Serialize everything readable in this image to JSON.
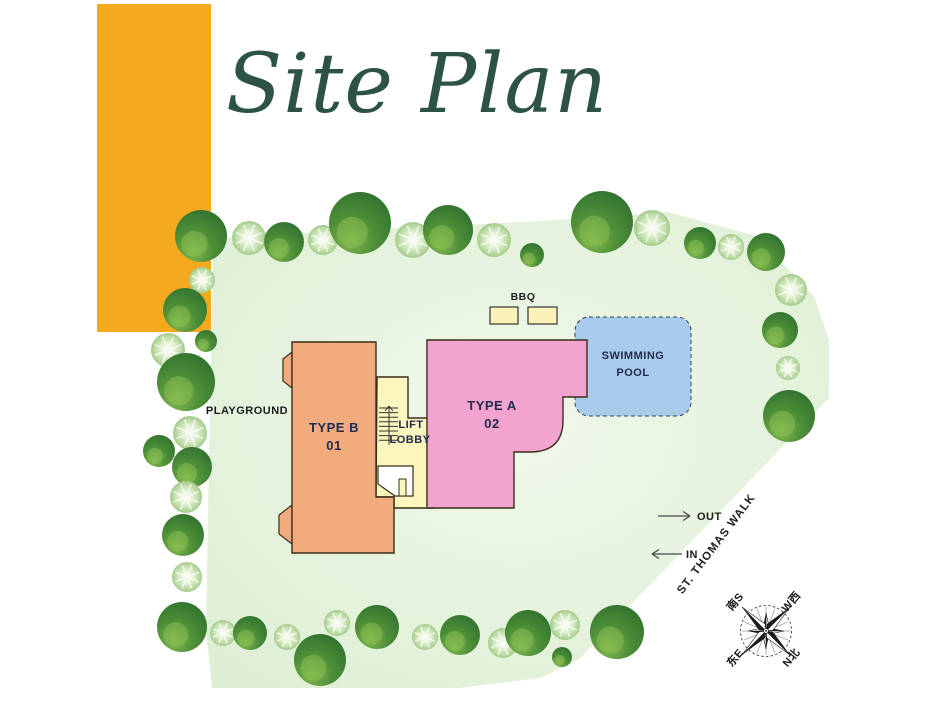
{
  "header": {
    "title": "Site Plan",
    "title_color": "#2d5246",
    "accent_bar_color": "#F5A91F"
  },
  "plan": {
    "site": {
      "polygon": "213,238 540,221 668,212 756,236 814,296 829,340 829,398 578,660 540,678 460,688 212,688 206,630",
      "fill_center": "#f0f8ea",
      "fill_edge": "#ddeed3"
    },
    "tree_colors": {
      "dark_outer": "#2a6c2d",
      "dark_mid": "#4e8f38",
      "dark_light": "#86bb50",
      "light_core": "#ffffff",
      "light_mid": "#dceecb",
      "light_edge": "#8fbf72"
    },
    "trees": [
      [
        "d",
        201,
        236,
        26
      ],
      [
        "l",
        249,
        238,
        17
      ],
      [
        "d",
        284,
        242,
        20
      ],
      [
        "l",
        323,
        240,
        15
      ],
      [
        "d",
        360,
        223,
        31
      ],
      [
        "l",
        413,
        240,
        18
      ],
      [
        "d",
        448,
        230,
        25
      ],
      [
        "l",
        494,
        240,
        17
      ],
      [
        "d",
        532,
        255,
        12
      ],
      [
        "d",
        602,
        222,
        31
      ],
      [
        "l",
        652,
        228,
        18
      ],
      [
        "d",
        700,
        243,
        16
      ],
      [
        "l",
        731,
        247,
        13
      ],
      [
        "d",
        766,
        252,
        19
      ],
      [
        "l",
        791,
        290,
        16
      ],
      [
        "d",
        780,
        330,
        18
      ],
      [
        "l",
        788,
        368,
        12
      ],
      [
        "d",
        789,
        416,
        26
      ],
      [
        "l",
        202,
        280,
        13
      ],
      [
        "d",
        185,
        310,
        22
      ],
      [
        "d",
        206,
        341,
        11
      ],
      [
        "l",
        168,
        350,
        17
      ],
      [
        "d",
        186,
        382,
        29
      ],
      [
        "l",
        190,
        433,
        17
      ],
      [
        "d",
        159,
        451,
        16
      ],
      [
        "d",
        192,
        467,
        20
      ],
      [
        "l",
        186,
        497,
        16
      ],
      [
        "d",
        183,
        535,
        21
      ],
      [
        "l",
        187,
        577,
        15
      ],
      [
        "d",
        182,
        627,
        25
      ],
      [
        "l",
        223,
        633,
        13
      ],
      [
        "d",
        250,
        633,
        17
      ],
      [
        "l",
        287,
        637,
        13
      ],
      [
        "d",
        320,
        660,
        26
      ],
      [
        "l",
        337,
        623,
        13
      ],
      [
        "d",
        377,
        627,
        22
      ],
      [
        "l",
        425,
        637,
        13
      ],
      [
        "d",
        460,
        635,
        20
      ],
      [
        "l",
        503,
        643,
        15
      ],
      [
        "d",
        528,
        633,
        23
      ],
      [
        "l",
        565,
        625,
        15
      ],
      [
        "d",
        562,
        657,
        10
      ],
      [
        "d",
        617,
        632,
        27
      ]
    ],
    "outline_color": "#3a2d1a",
    "label_color": "#232a52",
    "buildings": {
      "type_b": {
        "line1": "TYPE B",
        "line2": "01",
        "fill": "#f1ab7d",
        "path": "M292,342 L376,342 L376,497 L394,497 L394,553 L292,553 Z",
        "tabs": [
          "292,352 283,359 283,381 292,388",
          "292,505 279,515 279,534 292,544"
        ],
        "label_x": 334,
        "label_y1": 432,
        "label_y2": 450
      },
      "type_a": {
        "line1": "TYPE A",
        "line2": "02",
        "fill": "#f2a3ce",
        "path": "M433,340 L587,340 L587,397 L563,397 L563,420 Q563,452 530,452 L514,452 L514,508 L427,508 L427,340 Z",
        "label_x": 492,
        "label_y1": 410,
        "label_y2": 428
      },
      "lobby": {
        "line1": "LIFT",
        "line2": "LOBBY",
        "fill": "#fbf5be",
        "path": "M377,377 L408,377 L408,418 L433,418 L433,508 L394,508 L394,497 L376,497 Z",
        "notch": "378,466 413,466 413,496 395,496 378,484",
        "notch_tab": {
          "x": 399,
          "y": 479,
          "w": 7,
          "h": 17
        },
        "stairs": {
          "x1": 379,
          "x2": 398,
          "y_top": 408,
          "rungs": 8,
          "step": 4.6,
          "arrow_x": 389
        },
        "label_x1": 411,
        "label_y1": 428,
        "label_x2": 410,
        "label_y2": 443
      },
      "pool": {
        "line1": "SWIMMING",
        "line2": "POOL",
        "fill": "#a9cbec",
        "x": 575,
        "y": 317,
        "w": 116,
        "h": 99,
        "rx": 14,
        "label_x": 633,
        "label_y1": 359,
        "label_y2": 376
      }
    },
    "bbq": {
      "label": "BBQ",
      "label_x": 523,
      "label_y": 300,
      "fill": "#faf2b8",
      "pits": [
        {
          "x": 490,
          "y": 307,
          "w": 28,
          "h": 17
        },
        {
          "x": 528,
          "y": 307,
          "w": 29,
          "h": 17
        }
      ]
    },
    "playground": {
      "label": "PLAYGROUND",
      "x": 247,
      "y": 414
    },
    "arrows": {
      "out": {
        "label": "OUT",
        "x1": 658,
        "x2": 690,
        "y": 516,
        "tx": 697,
        "ty": 520,
        "dir": "right"
      },
      "in": {
        "label": "IN",
        "x1": 682,
        "x2": 652,
        "y": 554,
        "tx": 686,
        "ty": 558,
        "dir": "left"
      }
    },
    "road": {
      "name": "ST. THOMAS WALK",
      "x": 719,
      "y": 546,
      "angle": -53
    },
    "compass": {
      "cx": 766,
      "cy": 631,
      "ring_r": 25.5,
      "long_r": 34,
      "short_r": 18,
      "labels": [
        {
          "text": "南S",
          "dx": -28,
          "dy": -27
        },
        {
          "text": "W西",
          "dx": 28,
          "dy": -27
        },
        {
          "text": "东E",
          "dx": -28,
          "dy": 29
        },
        {
          "text": "N北",
          "dx": 28,
          "dy": 29
        }
      ],
      "label_angle": -50
    }
  }
}
